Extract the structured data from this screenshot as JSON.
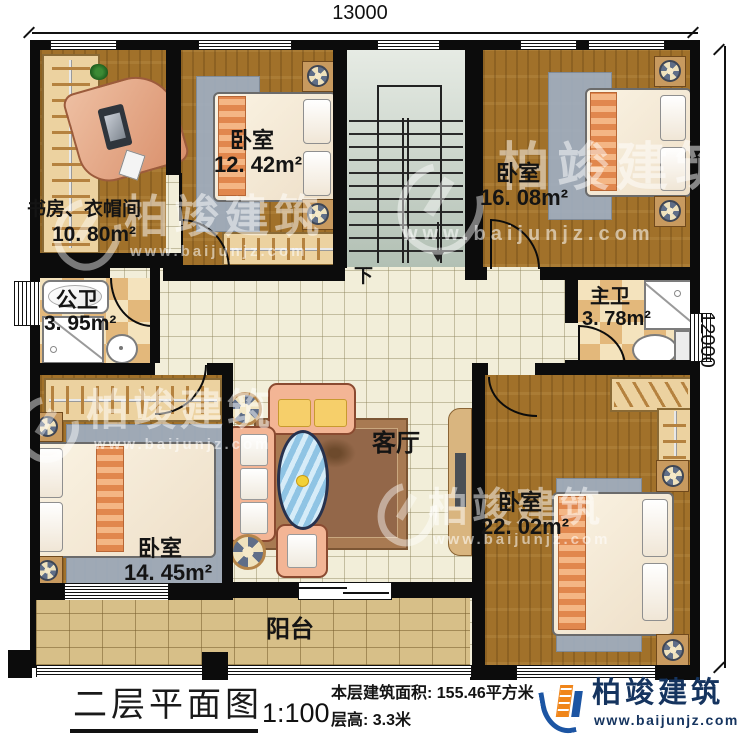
{
  "dimensions": {
    "top": "13000",
    "right": "12000"
  },
  "rooms": {
    "study": {
      "name": "书房、衣帽间",
      "area": "10. 80m²"
    },
    "bedroom_nw": {
      "name": "卧室",
      "area": "12. 42m²"
    },
    "bedroom_ne": {
      "name": "卧室",
      "area": "16. 08m²"
    },
    "bath_public": {
      "name": "公卫",
      "area": "3. 95m²"
    },
    "bath_master": {
      "name": "主卫",
      "area": "3. 78m²"
    },
    "bedroom_sw": {
      "name": "卧室",
      "area": "14. 45m²"
    },
    "bedroom_se": {
      "name": "卧室",
      "area": "22. 02m²"
    },
    "living": {
      "name": "客厅"
    },
    "balcony": {
      "name": "阳台"
    }
  },
  "stairs": {
    "direction_label": "下"
  },
  "title_block": {
    "plan_title": "二层平面图",
    "scale": "1:100",
    "area_text": "本层建筑面积: 155.46平方米",
    "floor_height_text": "层高: 3.3米"
  },
  "brand": {
    "name": "柏竣建筑",
    "website": "www.baijunjz.com"
  },
  "watermark": {
    "name": "柏竣建筑",
    "website": "www.baijunjz.com"
  },
  "colors": {
    "wall": "#0c0c0c",
    "wood_floor": "#a1712a",
    "tile_floor": "#f2eed9",
    "bath_tile": "#e3b87b",
    "balcony_brick": "#d7bf88",
    "stair_floor": "#c9d4ca",
    "brand_navy": "#15345f",
    "brand_orange": "#f08519",
    "brand_blue": "#1c55a3"
  }
}
